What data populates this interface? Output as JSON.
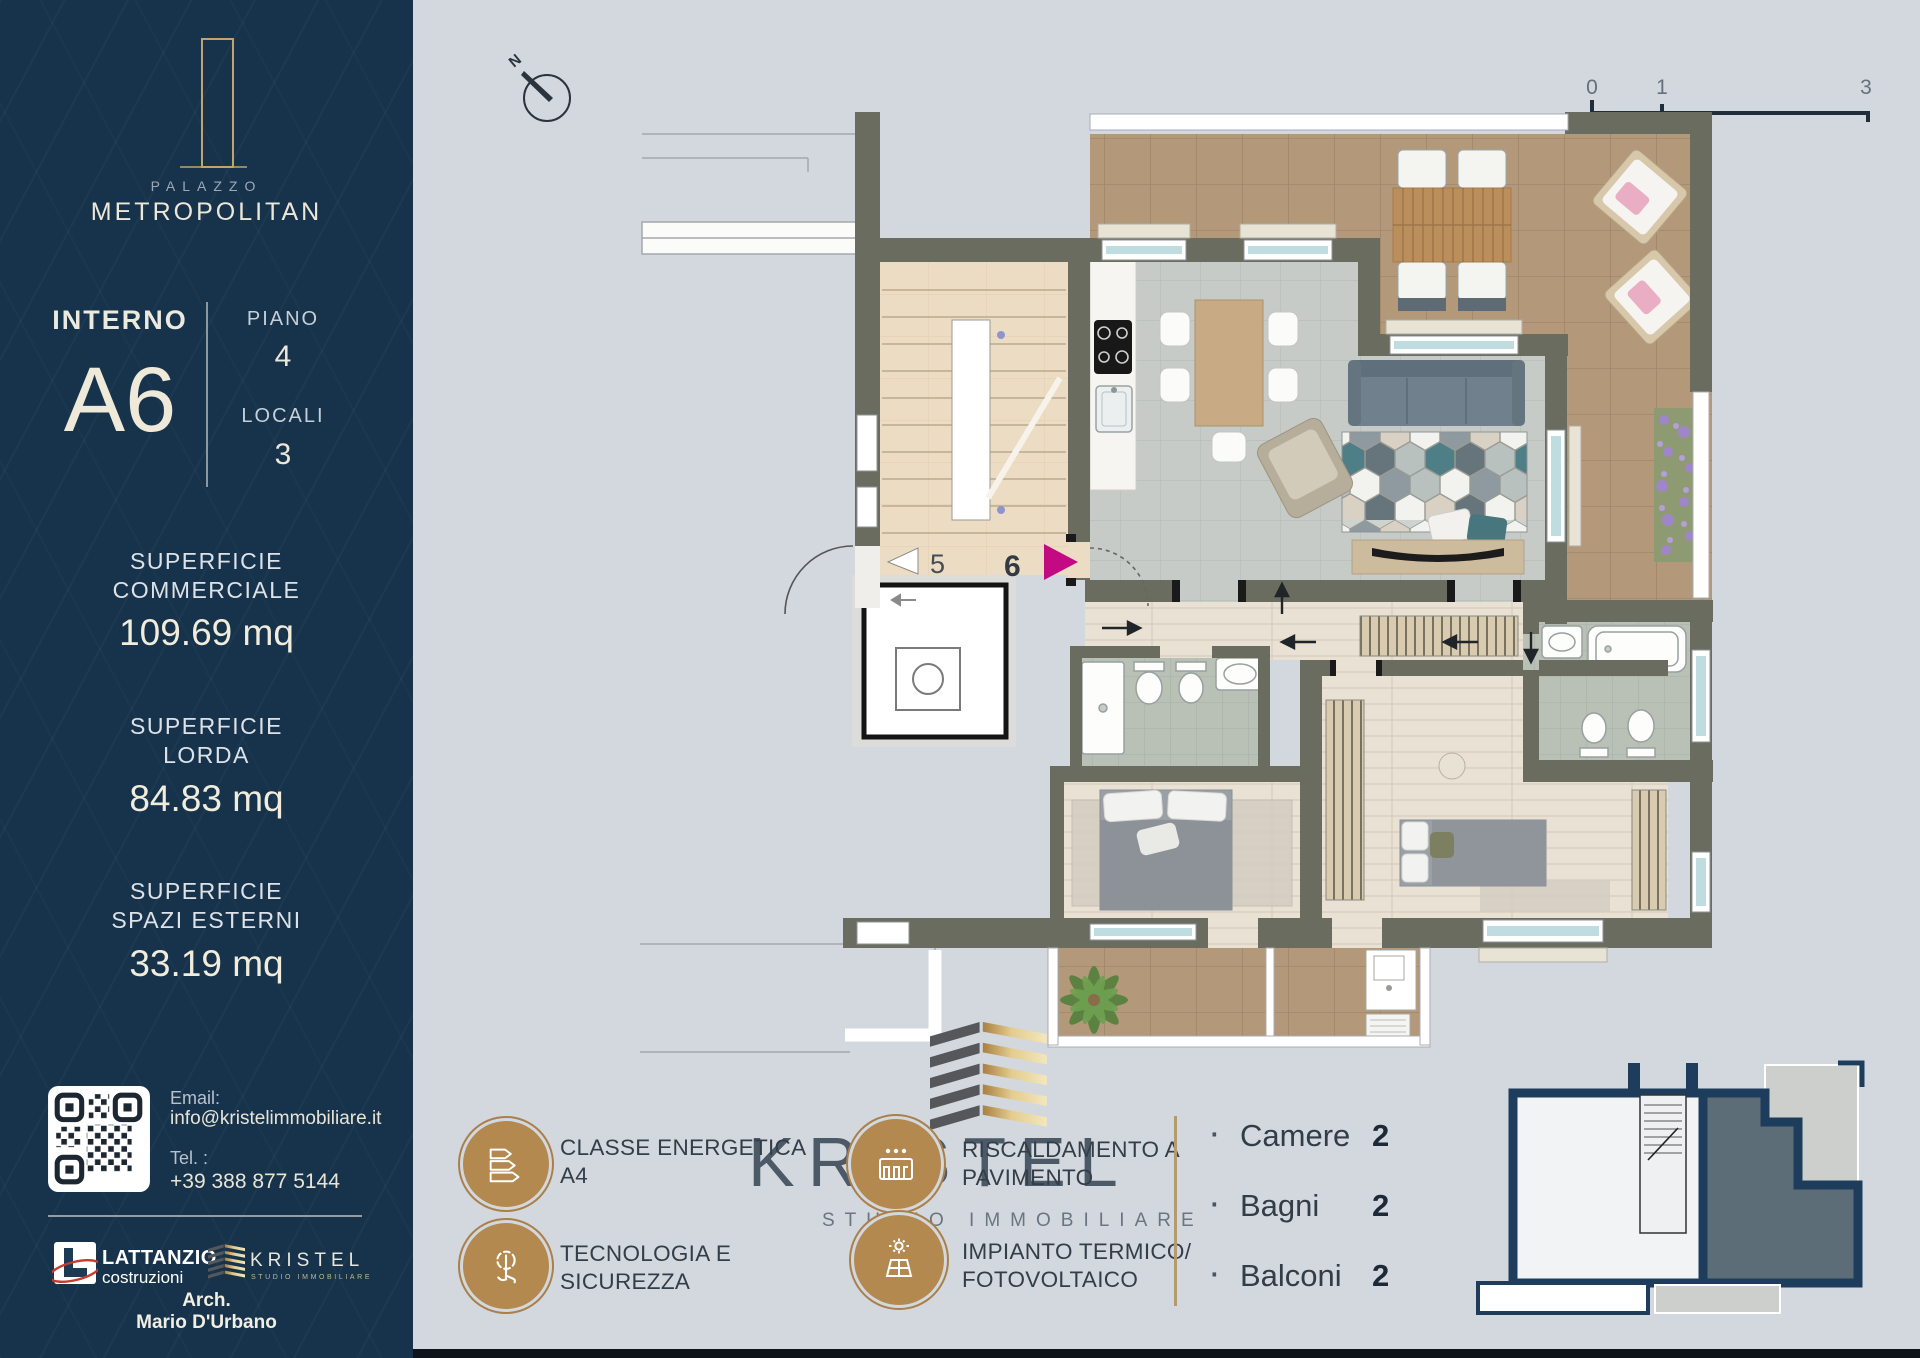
{
  "colors": {
    "sidebar_navy": "#16334b",
    "canvas_gray": "#d3d7de",
    "brand_gold": "#b3894f",
    "cream_text": "#efe9d9",
    "wall_olive": "#6a6c60",
    "terrace_tile": "#b39879",
    "magenta_arrow": "#c40a82",
    "keyplan_navy": "#1e3c5c"
  },
  "sidebar": {
    "brand": {
      "icon": "tower-logo-icon",
      "palazzo": "PALAZZO",
      "name": "METROPOLITAN"
    },
    "unit": {
      "interno_label": "INTERNO",
      "interno_value": "A6",
      "piano_label": "PIANO",
      "piano_value": "4",
      "locali_label": "LOCALI",
      "locali_value": "3"
    },
    "areas": [
      {
        "line1": "SUPERFICIE",
        "line2": "COMMERCIALE",
        "value": "109.69 mq"
      },
      {
        "line1": "SUPERFICIE",
        "line2": "LORDA",
        "value": "84.83 mq"
      },
      {
        "line1": "SUPERFICIE",
        "line2": "SPAZI ESTERNI",
        "value": "33.19 mq"
      }
    ],
    "contact": {
      "qr_icon": "qr-code",
      "email_label": "Email:",
      "email_value": "info@kristelimmobiliare.it",
      "tel_label": "Tel. :",
      "tel_value": "+39 388 877 5144"
    },
    "partners": {
      "lattanzio_icon": "lattanzio-logo-icon",
      "lattanzio_name": "LATTANZIO",
      "lattanzio_sub": "costruzioni",
      "kristel_icon": "kristel-building-icon",
      "kristel_name": "KRISTEL",
      "kristel_sub": "STUDIO IMMOBILIARE"
    },
    "architect": {
      "title": "Arch.",
      "name": "Mario D'Urbano"
    }
  },
  "plan": {
    "compass_label": "N",
    "scale": {
      "t0": "0",
      "t1": "1",
      "t3": "3"
    },
    "door_labels": {
      "neighbor": "5",
      "unit": "6"
    }
  },
  "footer": {
    "features": [
      {
        "icon": "energy-class-icon",
        "line1": "CLASSE ENERGETICA",
        "line2": "A4"
      },
      {
        "icon": "touch-security-icon",
        "line1": "TECNOLOGIA E",
        "line2": "SICUREZZA"
      },
      {
        "icon": "floor-heating-icon",
        "line1": "RISCALDAMENTO A",
        "line2": "PAVIMENTO"
      },
      {
        "icon": "solar-panel-icon",
        "line1": "IMPIANTO TERMICO/",
        "line2": "FOTOVOLTAICO"
      }
    ],
    "agency": {
      "icon": "kristel-building-icon",
      "wordmark": "KRISTEL",
      "sub": "STUDIO IMMOBILIARE"
    },
    "stats": [
      {
        "bullet": "·",
        "label": "Camere",
        "value": "2"
      },
      {
        "bullet": "·",
        "label": "Bagni",
        "value": "2"
      },
      {
        "bullet": "·",
        "label": "Balconi",
        "value": "2"
      }
    ]
  }
}
